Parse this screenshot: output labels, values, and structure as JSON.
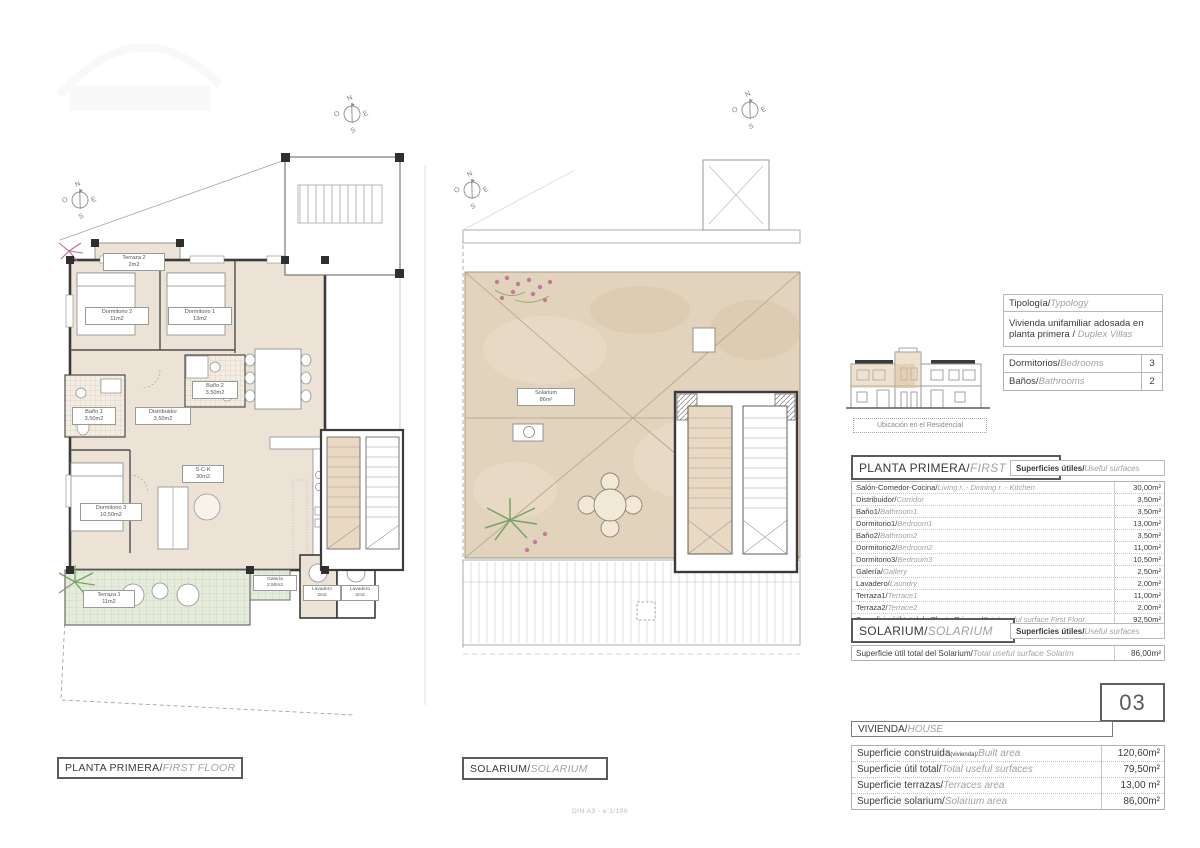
{
  "typ": {
    "label_es": "Tipología/",
    "label_en": "Typology",
    "value_es": "Vivienda unifamiliar adosada en planta primera / ",
    "value_en": "Duplex Villas"
  },
  "counts": {
    "rows": [
      {
        "es": "Dormitorios/",
        "en": "Bedrooms",
        "value": "3"
      },
      {
        "es": "Baños/",
        "en": "Bathrooms",
        "value": "2"
      }
    ]
  },
  "misc": {
    "location_caption": "Ubicación en el Residencial",
    "scale_note": "DIN A3 - e:1/100"
  },
  "ff": {
    "title_es": "PLANTA PRIMERA/",
    "title_en": "FIRST FLOOR",
    "surfaces_es": "Superficies útiles/",
    "surfaces_en": "Useful surfaces",
    "rows": [
      {
        "es": "Salón-Comedor-Cocina/",
        "en": "Living r. - Dinning r. - Kitchen",
        "value": "30,00m²"
      },
      {
        "es": "Distribuidor/",
        "en": "Corridor",
        "value": "3,50m²"
      },
      {
        "es": "Baño1/",
        "en": "Bathroom1",
        "value": "3,50m²"
      },
      {
        "es": "Dormitorio1/",
        "en": "Bedroom1",
        "value": "13,00m²"
      },
      {
        "es": "Baño2/",
        "en": "Bathroom2",
        "value": "3,50m²"
      },
      {
        "es": "Dormitorio2/",
        "en": "Bedroom2",
        "value": "11,00m²"
      },
      {
        "es": "Dormitorio3/",
        "en": "Bedroom3",
        "value": "10,50m²"
      },
      {
        "es": "Galería/",
        "en": "Gallery",
        "value": "2,50m²"
      },
      {
        "es": "Lavadero/",
        "en": "Laundry",
        "value": "2,00m²"
      },
      {
        "es": "Terraza1/",
        "en": "Terrace1",
        "value": "11,00m²"
      },
      {
        "es": "Terraza2/",
        "en": "Terrace2",
        "value": "2,00m²"
      },
      {
        "es": "Superficie útil total de Planta Primera/",
        "en": "Total useful surface First Floor.",
        "value": "92,50m²"
      }
    ]
  },
  "sol": {
    "title_es": "SOLARIUM/",
    "title_en": "SOLARIUM",
    "surfaces_es": "Superficies útiles/",
    "surfaces_en": "Useful surfaces",
    "row": {
      "es": "Superficie útil total del Solarium/",
      "en": "Total useful surface Solarim",
      "value": "86,00m²"
    }
  },
  "unit": {
    "number": "03",
    "label_es": "VIVIENDA/",
    "label_en": "HOUSE"
  },
  "house": {
    "rows": [
      {
        "es": "Superficie construida",
        "sub": "(vivienda)/",
        "en": "Built area",
        "value": "120,60m²"
      },
      {
        "es": "Superficie útil total/",
        "sub": "",
        "en": "Total useful surfaces",
        "value": "79,50m²"
      },
      {
        "es": "Superficie terrazas/",
        "sub": "",
        "en": "Terraces area",
        "value": "13,00 m²"
      },
      {
        "es": "Superficie solarium/",
        "sub": "",
        "en": "Solarium area",
        "value": "86,00m²"
      }
    ]
  },
  "plan1": {
    "caption_es": "PLANTA PRIMERA/",
    "caption_en": "FIRST FLOOR",
    "rooms": {
      "terraza2": {
        "name": "Terraza 2",
        "area": "2m2"
      },
      "dormitorio2": {
        "name": "Dormitorio 2",
        "area": "11m2"
      },
      "dormitorio1": {
        "name": "Dormitorio 1",
        "area": "13m2"
      },
      "bano2": {
        "name": "Baño 2",
        "area": "3,50m2"
      },
      "bano1": {
        "name": "Baño 1",
        "area": "3,50m2"
      },
      "distribuidor": {
        "name": "Distribuidor",
        "area": "3,50m2"
      },
      "dormitorio3": {
        "name": "Dormitorio 3",
        "area": "10,50m2"
      },
      "sck": {
        "name": "S-C-K",
        "area": "30m2"
      },
      "galeria": {
        "name": "Galería",
        "area": "2,50m2"
      },
      "lavadero_a": {
        "name": "Lavadero",
        "area": "2m2"
      },
      "lavadero_b": {
        "name": "Lavadero",
        "area": "2m2"
      },
      "terraza1": {
        "name": "Terraza 1",
        "area": "11m2"
      }
    }
  },
  "plan2": {
    "caption_es": "SOLARIUM/",
    "caption_en": "SOLARIUM",
    "rooms": {
      "solarium": {
        "name": "Solarium",
        "area": "86m²"
      }
    }
  },
  "compass": {
    "n": "N",
    "s": "S",
    "e": "E",
    "o": "O"
  },
  "colors": {
    "room_fill": "#ece3d6",
    "solarium_fill": "#e2d3bc",
    "terrace_fill": "#e6ecdc",
    "wall": "#3b3b3b",
    "table_border": "#b0b0b0",
    "plant_pink": "#c06a8a",
    "plant_green": "#76a263"
  }
}
